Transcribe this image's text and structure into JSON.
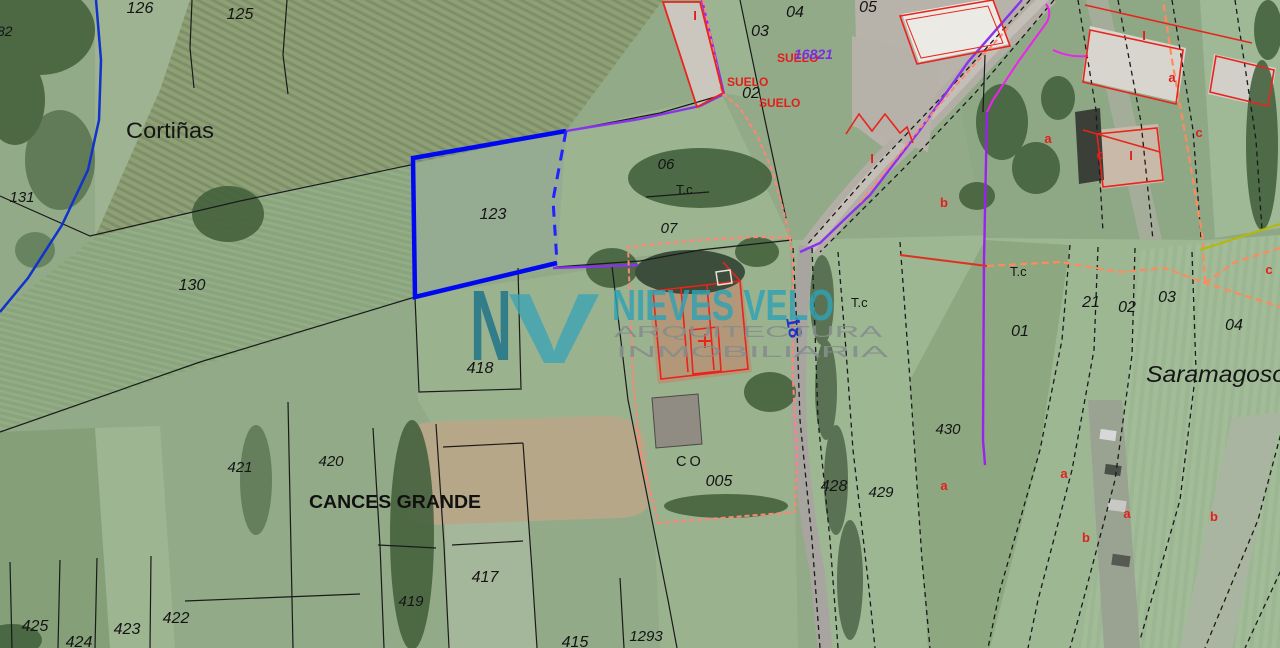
{
  "map": {
    "type": "cadastral-parcel-map-over-aerial-photo",
    "colors": {
      "highlight_parcel_stroke": "#0008f0",
      "parcel_line": "#1a1a1a",
      "road_axis_purple": "#8833ee",
      "magenta_line": "#ee22ee",
      "suelo_boundary_salmon": "#ff8576",
      "tc_dashed_orange": "#ff8a5c",
      "building_red": "#e8241c",
      "river_blue": "#1133cc",
      "watermark_teal": "#2fa3b5",
      "yellow_line": "#b8b800"
    },
    "highlighted_parcel": "123",
    "labels": [
      {
        "name": "parcel-82",
        "t": "82",
        "x": -3,
        "y": 36,
        "s": 14,
        "i": 1,
        "a": "start"
      },
      {
        "name": "parcel-126",
        "t": "126",
        "x": 140,
        "y": 13,
        "s": 16,
        "i": 1
      },
      {
        "name": "parcel-125",
        "t": "125",
        "x": 240,
        "y": 19,
        "s": 16,
        "i": 1
      },
      {
        "name": "parcel-131",
        "t": "131",
        "x": 22,
        "y": 202,
        "s": 15,
        "i": 1
      },
      {
        "name": "parcel-130",
        "t": "130",
        "x": 192,
        "y": 290,
        "s": 16,
        "i": 1
      },
      {
        "name": "parcel-123",
        "t": "123",
        "x": 493,
        "y": 219,
        "s": 16,
        "i": 1
      },
      {
        "name": "parcel-06",
        "t": "06",
        "x": 666,
        "y": 169,
        "s": 15,
        "i": 1
      },
      {
        "name": "parcel-07",
        "t": "07",
        "x": 669,
        "y": 233,
        "s": 15,
        "i": 1
      },
      {
        "name": "parcel-05",
        "t": "05",
        "x": 868,
        "y": 12,
        "s": 16,
        "i": 1
      },
      {
        "name": "parcel-03-top",
        "t": "03",
        "x": 760,
        "y": 36,
        "s": 16,
        "i": 1
      },
      {
        "name": "parcel-04-top",
        "t": "04",
        "x": 795,
        "y": 17,
        "s": 16,
        "i": 1
      },
      {
        "name": "parcel-02-top",
        "t": "02",
        "x": 751,
        "y": 98,
        "s": 16,
        "i": 1
      },
      {
        "name": "parcel-01",
        "t": "01",
        "x": 1020,
        "y": 336,
        "s": 16,
        "i": 1
      },
      {
        "name": "parcel-21",
        "t": "21",
        "x": 1091,
        "y": 307,
        "s": 16,
        "i": 1
      },
      {
        "name": "parcel-02-right",
        "t": "02",
        "x": 1127,
        "y": 312,
        "s": 16,
        "i": 1
      },
      {
        "name": "parcel-03-right",
        "t": "03",
        "x": 1167,
        "y": 302,
        "s": 16,
        "i": 1
      },
      {
        "name": "parcel-04-right",
        "t": "04",
        "x": 1234,
        "y": 330,
        "s": 16,
        "i": 1
      },
      {
        "name": "parcel-418",
        "t": "418",
        "x": 480,
        "y": 373,
        "s": 16,
        "i": 1
      },
      {
        "name": "parcel-421",
        "t": "421",
        "x": 240,
        "y": 472,
        "s": 15,
        "i": 1
      },
      {
        "name": "parcel-420",
        "t": "420",
        "x": 331,
        "y": 466,
        "s": 15,
        "i": 1
      },
      {
        "name": "parcel-422",
        "t": "422",
        "x": 176,
        "y": 623,
        "s": 16,
        "i": 1
      },
      {
        "name": "parcel-423",
        "t": "423",
        "x": 127,
        "y": 634,
        "s": 16,
        "i": 1
      },
      {
        "name": "parcel-424",
        "t": "424",
        "x": 79,
        "y": 647,
        "s": 16,
        "i": 1
      },
      {
        "name": "parcel-425",
        "t": "425",
        "x": 35,
        "y": 631,
        "s": 16,
        "i": 1
      },
      {
        "name": "parcel-417",
        "t": "417",
        "x": 485,
        "y": 582,
        "s": 16,
        "i": 1
      },
      {
        "name": "parcel-419",
        "t": "419",
        "x": 411,
        "y": 606,
        "s": 15,
        "i": 1
      },
      {
        "name": "parcel-415",
        "t": "415",
        "x": 575,
        "y": 647,
        "s": 16,
        "i": 1
      },
      {
        "name": "parcel-1293",
        "t": "1293",
        "x": 646,
        "y": 641,
        "s": 15,
        "i": 1
      },
      {
        "name": "parcel-005",
        "t": "005",
        "x": 719,
        "y": 486,
        "s": 16,
        "i": 1
      },
      {
        "name": "parcel-428",
        "t": "428",
        "x": 834,
        "y": 491,
        "s": 16,
        "i": 1
      },
      {
        "name": "parcel-429",
        "t": "429",
        "x": 881,
        "y": 497,
        "s": 15,
        "i": 1
      },
      {
        "name": "parcel-430",
        "t": "430",
        "x": 948,
        "y": 434,
        "s": 15,
        "i": 1
      },
      {
        "name": "place-cortinas",
        "t": "Cortiñas",
        "x": 126,
        "y": 138,
        "s": 22,
        "a": "start",
        "tl": 88,
        "c": "#151515"
      },
      {
        "name": "place-cances-grande",
        "t": "CANCES GRANDE",
        "x": 309,
        "y": 508,
        "s": 18.5,
        "w": 700,
        "a": "start",
        "tl": 172,
        "c": "#111111"
      },
      {
        "name": "place-saramagoso",
        "t": "Saramagoso",
        "x": 1146,
        "y": 382,
        "s": 23,
        "i": 1,
        "a": "start",
        "tl": 140,
        "c": "#151515"
      },
      {
        "name": "zone-tc-1",
        "t": "T.c",
        "x": 676,
        "y": 194,
        "s": 13,
        "a": "start"
      },
      {
        "name": "zone-tc-2",
        "t": "T.c",
        "x": 851,
        "y": 307,
        "s": 13,
        "a": "start"
      },
      {
        "name": "zone-tc-3",
        "t": "T.c",
        "x": 1010,
        "y": 276,
        "s": 13,
        "a": "start"
      },
      {
        "name": "zone-co",
        "t": "CO",
        "x": 676,
        "y": 466,
        "s": 14.5,
        "ls": 3,
        "a": "start"
      },
      {
        "name": "zone-suelo-1",
        "t": "SUELO",
        "x": 777,
        "y": 62,
        "s": 12,
        "w": 700,
        "c": "#e0201c",
        "a": "start"
      },
      {
        "name": "zone-suelo-2",
        "t": "SUELO",
        "x": 727,
        "y": 86,
        "s": 12,
        "w": 700,
        "c": "#e0201c",
        "a": "start"
      },
      {
        "name": "zone-suelo-3",
        "t": "SUELO",
        "x": 759,
        "y": 107,
        "s": 12,
        "w": 700,
        "c": "#e0201c",
        "a": "start"
      },
      {
        "name": "road-ref-purple",
        "t": "16821",
        "x": 794,
        "y": 59,
        "s": 14,
        "w": 700,
        "i": 1,
        "c": "#7a2fe0",
        "a": "start"
      },
      {
        "name": "road-km-18",
        "t": "18",
        "x": 786,
        "y": 318,
        "s": 19,
        "w": 700,
        "c": "#2233cc",
        "r": 80,
        "a": "start"
      },
      {
        "name": "mark-i-1",
        "t": "I",
        "x": 695,
        "y": 20,
        "s": 13,
        "w": 700,
        "c": "#e0201c"
      },
      {
        "name": "mark-i-2",
        "t": "I",
        "x": 872,
        "y": 163,
        "s": 13,
        "w": 700,
        "c": "#e0201c"
      },
      {
        "name": "mark-i-3",
        "t": "I",
        "x": 1144,
        "y": 40,
        "s": 13,
        "w": 700,
        "c": "#e0201c"
      },
      {
        "name": "mark-i-4",
        "t": "I",
        "x": 1131,
        "y": 160,
        "s": 13,
        "w": 700,
        "c": "#e0201c"
      },
      {
        "name": "mark-a-1",
        "t": "a",
        "x": 1048,
        "y": 143,
        "s": 13,
        "w": 700,
        "c": "#e0201c"
      },
      {
        "name": "mark-a-2",
        "t": "a",
        "x": 1172,
        "y": 82,
        "s": 13,
        "w": 700,
        "c": "#e0201c"
      },
      {
        "name": "mark-a-3",
        "t": "a",
        "x": 944,
        "y": 490,
        "s": 13,
        "w": 700,
        "c": "#e0201c"
      },
      {
        "name": "mark-a-4",
        "t": "a",
        "x": 1064,
        "y": 478,
        "s": 13,
        "w": 700,
        "c": "#e0201c"
      },
      {
        "name": "mark-a-5",
        "t": "a",
        "x": 1127,
        "y": 518,
        "s": 13,
        "w": 700,
        "c": "#e0201c"
      },
      {
        "name": "mark-b-1",
        "t": "b",
        "x": 944,
        "y": 207,
        "s": 13,
        "w": 700,
        "c": "#e0201c"
      },
      {
        "name": "mark-b-2",
        "t": "b",
        "x": 1086,
        "y": 542,
        "s": 13,
        "w": 700,
        "c": "#e0201c"
      },
      {
        "name": "mark-b-3",
        "t": "b",
        "x": 1214,
        "y": 521,
        "s": 13,
        "w": 700,
        "c": "#e0201c"
      },
      {
        "name": "mark-c-1",
        "t": "c",
        "x": 1100,
        "y": 159,
        "s": 13,
        "w": 700,
        "c": "#e0201c"
      },
      {
        "name": "mark-c-2",
        "t": "c",
        "x": 1199,
        "y": 137,
        "s": 13,
        "w": 700,
        "c": "#e0201c"
      },
      {
        "name": "mark-c-3",
        "t": "c",
        "x": 1269,
        "y": 274,
        "s": 13,
        "w": 700,
        "c": "#e0201c"
      }
    ]
  },
  "watermark": {
    "labels": [
      {
        "name": "watermark-monogram-n",
        "t": "N",
        "x": 470,
        "y": 360,
        "s": 100,
        "w": 700,
        "c": "#18708a",
        "o": 0.8,
        "a": "start",
        "tl": 42
      },
      {
        "name": "watermark-monogram-v",
        "t": "V",
        "x": 508,
        "y": 363,
        "s": 100,
        "w": 700,
        "c": "#3ea3b6",
        "o": 0.8,
        "a": "start",
        "tl": 92
      },
      {
        "name": "watermark-title",
        "t": "NIEVES VELO",
        "x": 612,
        "y": 320,
        "s": 44,
        "w": 700,
        "c": "#2fa3b5",
        "o": 0.82,
        "a": "start",
        "tl": 222
      },
      {
        "name": "watermark-sub-1",
        "t": "ARQUITECTURA",
        "x": 614,
        "y": 337,
        "s": 16,
        "c": "#868e8c",
        "o": 0.92,
        "a": "start",
        "tl": 268
      },
      {
        "name": "watermark-sub-2",
        "t": "INMOBILIARIA",
        "x": 616,
        "y": 357,
        "s": 16,
        "c": "#868e8c",
        "o": 0.92,
        "a": "start",
        "tl": 272
      }
    ]
  }
}
